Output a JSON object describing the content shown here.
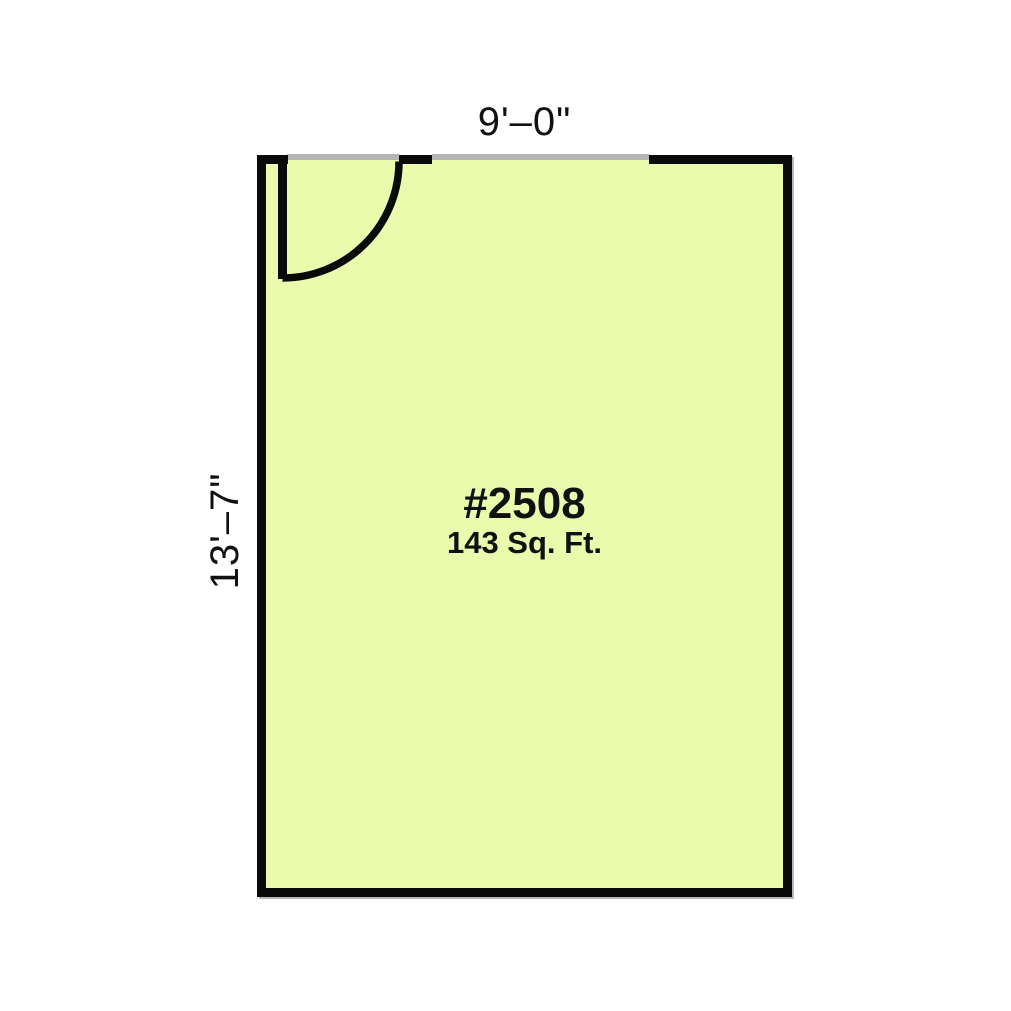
{
  "floor_plan": {
    "unit_number": "#2508",
    "area": "143 Sq. Ft.",
    "width_dimension": "9'–0\"",
    "height_dimension": "13'–7\"",
    "colors": {
      "room_fill": "#eafbae",
      "wall": "#0a0a0a",
      "opening": "#b4b4b4",
      "text": "#111111",
      "background": "#ffffff"
    }
  }
}
